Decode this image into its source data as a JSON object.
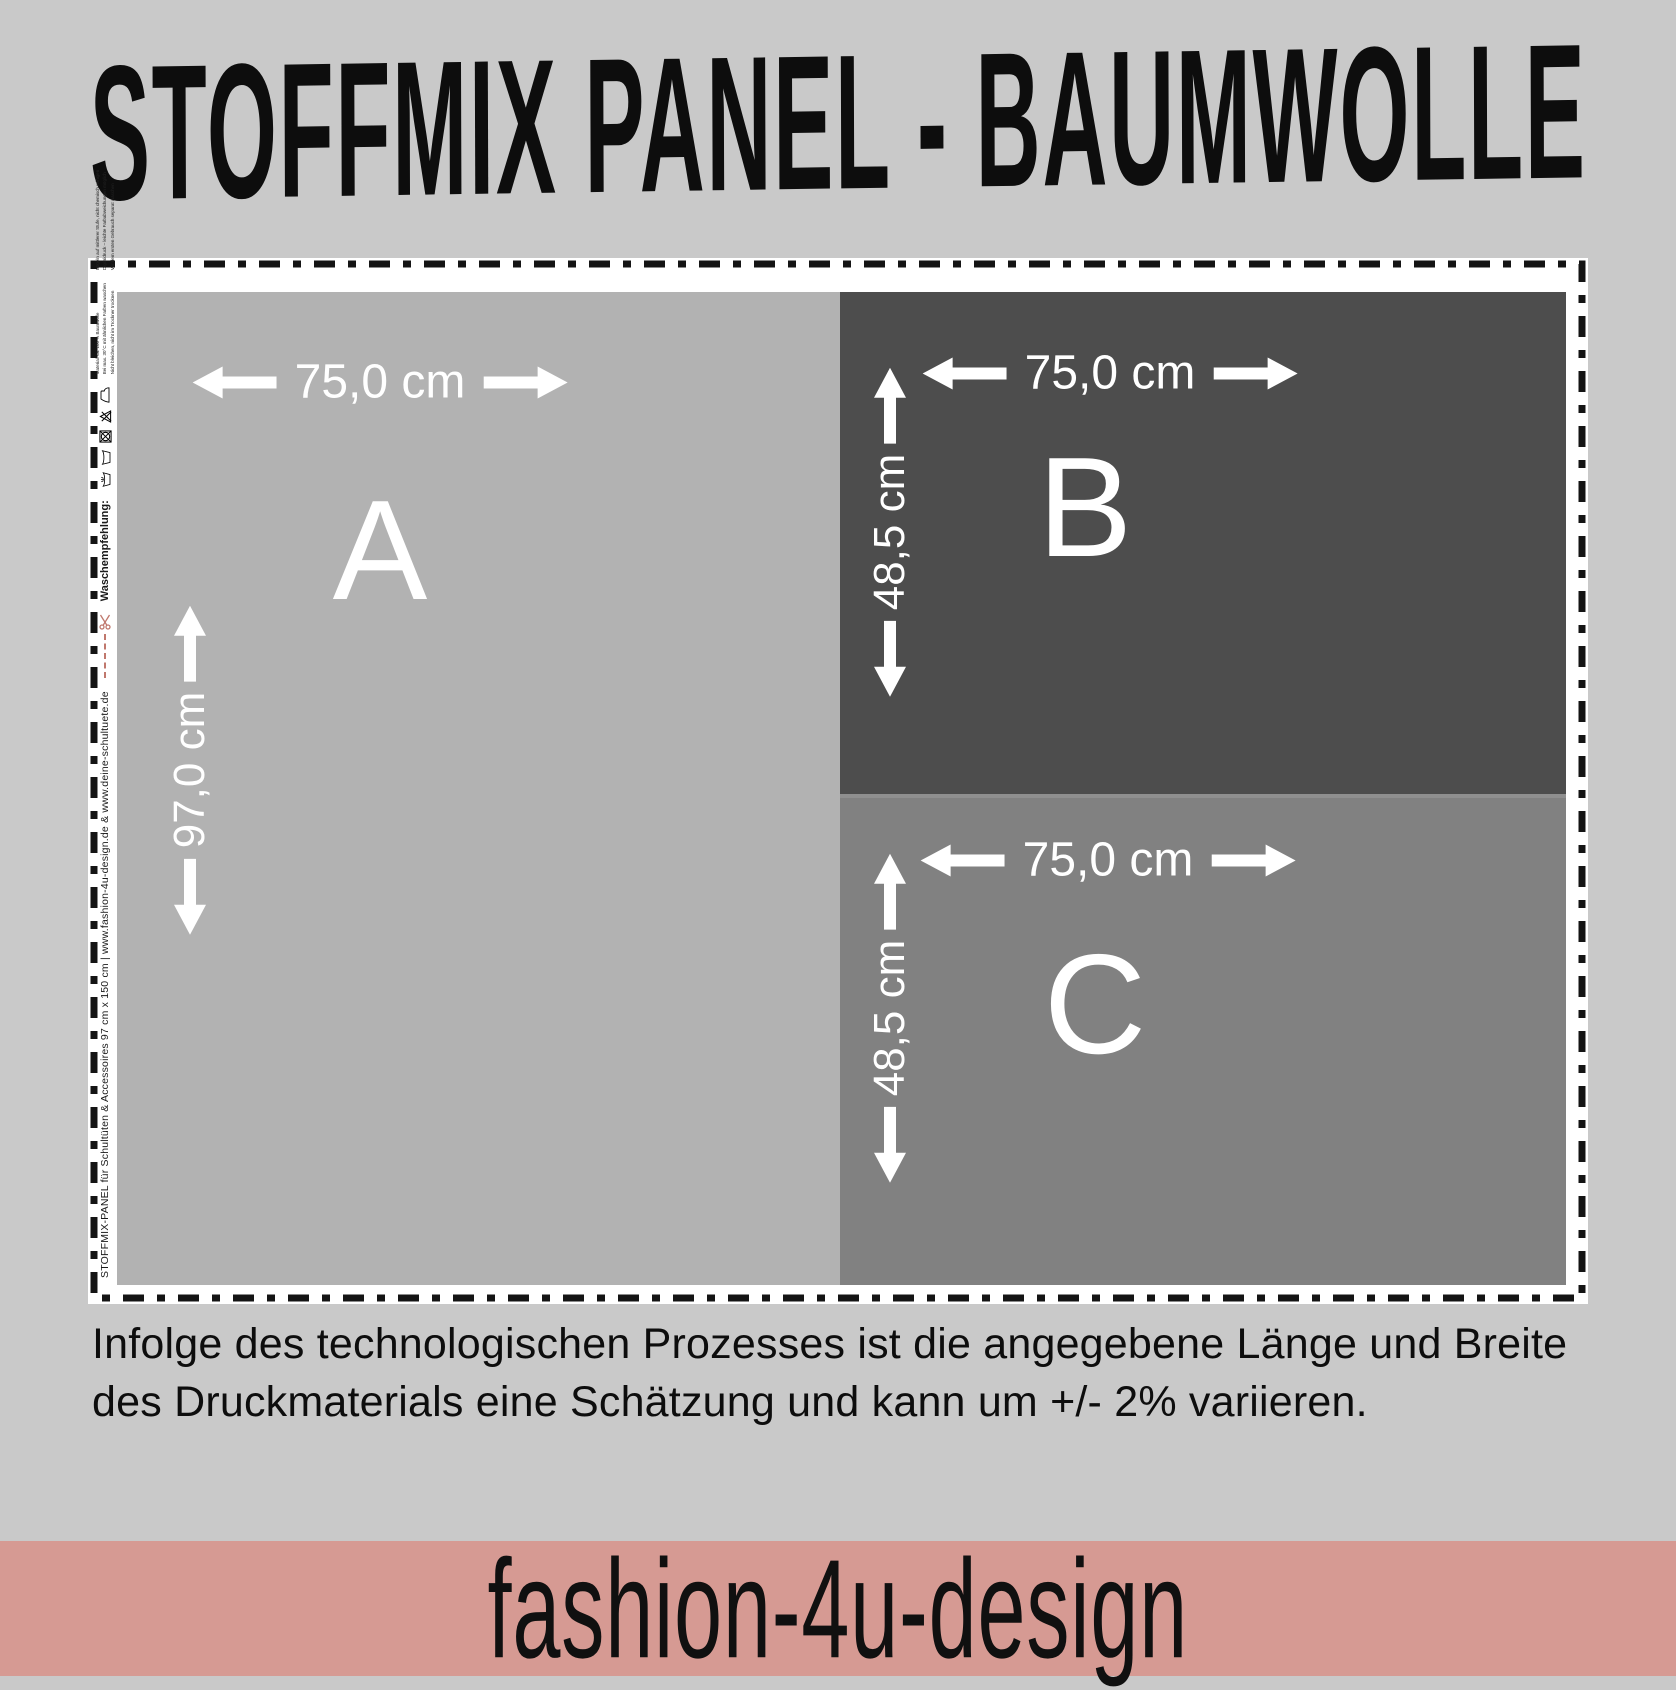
{
  "title": "STOFFMIX PANEL - BAUMWOLLE",
  "panels": [
    {
      "id": "A",
      "label": "A",
      "width_label": "75,0 cm",
      "height_label": "97,0 cm",
      "color": "#b2b2b2"
    },
    {
      "id": "B",
      "label": "B",
      "width_label": "75,0 cm",
      "height_label": "48,5 cm",
      "color": "#4d4d4d"
    },
    {
      "id": "C",
      "label": "C",
      "width_label": "75,0 cm",
      "height_label": "48,5 cm",
      "color": "#818181"
    }
  ],
  "selvage": {
    "info_text": "STOFFMIX-PANEL für Schultüten & Accessoires 97 cm x 150 cm | www.fashion-4u-design.de & www.deine-schultuete.de",
    "wash_label": "Waschempfehlung:",
    "care_icons": [
      "hand-wash",
      "wash-tub",
      "no-tumble-dry",
      "no-bleach",
      "iron"
    ],
    "fine_print": [
      "Material: ca. 100 % Baumwolle",
      "Bei max. 30°C mit ähnlichen Farben waschen",
      "Nicht bleichen, nicht im Trockner trocknen",
      "Bügeln auf mittlerer Stufe, nicht chemisch reinigen",
      "Digitaldruck – leichte Farbabweichungen möglich",
      "Vor dem ersten Gebrauch separat waschen"
    ]
  },
  "disclaimer": {
    "line1": "Infolge des technologischen Prozesses ist die angegebene Länge und Breite",
    "line2": "des Druckmaterials eine Schätzung und kann um +/- 2% variieren."
  },
  "footer": {
    "brand": "fashion-4u-design"
  },
  "colors": {
    "background": "#c9c9c9",
    "panel_a": "#b2b2b2",
    "panel_b": "#4d4d4d",
    "panel_c": "#818181",
    "divider": "#8f8f8f",
    "banner": "#d69a93",
    "cut_sheet": "#ffffff",
    "dash": "#141414",
    "accent_pink": "#c0786d",
    "dim_text": "#ffffff",
    "text": "#111111"
  }
}
